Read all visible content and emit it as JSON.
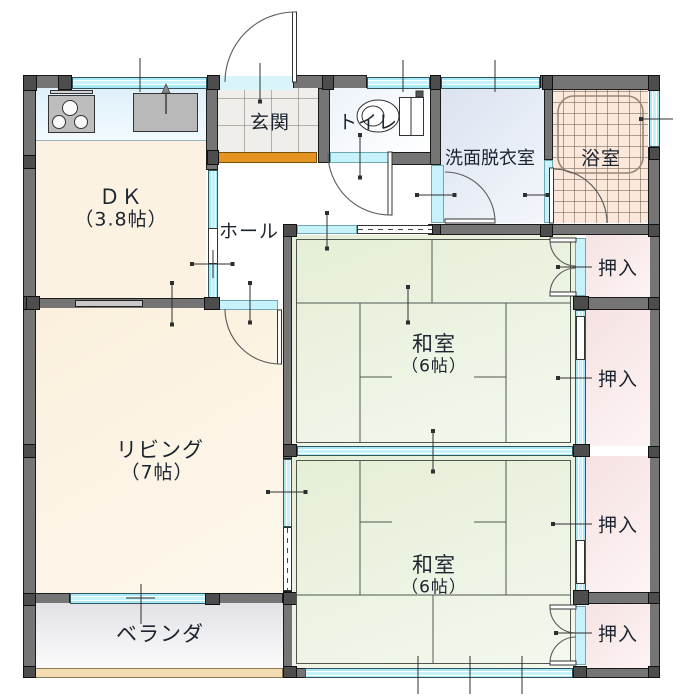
{
  "plan_type": "floor-plan",
  "rooms": {
    "dk": {
      "label": "ＤＫ",
      "size": "（3.8帖）"
    },
    "living": {
      "label": "リビング",
      "size": "（7帖）"
    },
    "washitsu_upper": {
      "label": "和室",
      "size": "（6帖）"
    },
    "washitsu_lower": {
      "label": "和室",
      "size": "（6帖）"
    },
    "genkan": {
      "label": "玄関"
    },
    "hall": {
      "label": "ホール"
    },
    "toilet": {
      "label": "トイレ"
    },
    "washroom": {
      "label": "洗面脱衣室"
    },
    "bathroom": {
      "label": "浴室"
    },
    "veranda": {
      "label": "ベランダ"
    },
    "closet_1": {
      "label": "押入"
    },
    "closet_2": {
      "label": "押入"
    },
    "closet_3": {
      "label": "押入"
    },
    "closet_4": {
      "label": "押入"
    }
  },
  "colors": {
    "wall": "#757575",
    "post": "#4d4d4d",
    "window_cyan": "#b5eef9",
    "tatami_green": "#e9f1dd",
    "closet_pink": "#f7e7e7",
    "wood_cream": "#fbf2e2",
    "kitchen_blue": "#e6f4fc",
    "washroom_blue": "#e2e9f4",
    "bathroom_peach": "#fbe9da",
    "veranda_gray": "#e9e9ec",
    "entry_step_orange": "#e5941f",
    "outer_ledge_tan": "#f4dcb2"
  }
}
